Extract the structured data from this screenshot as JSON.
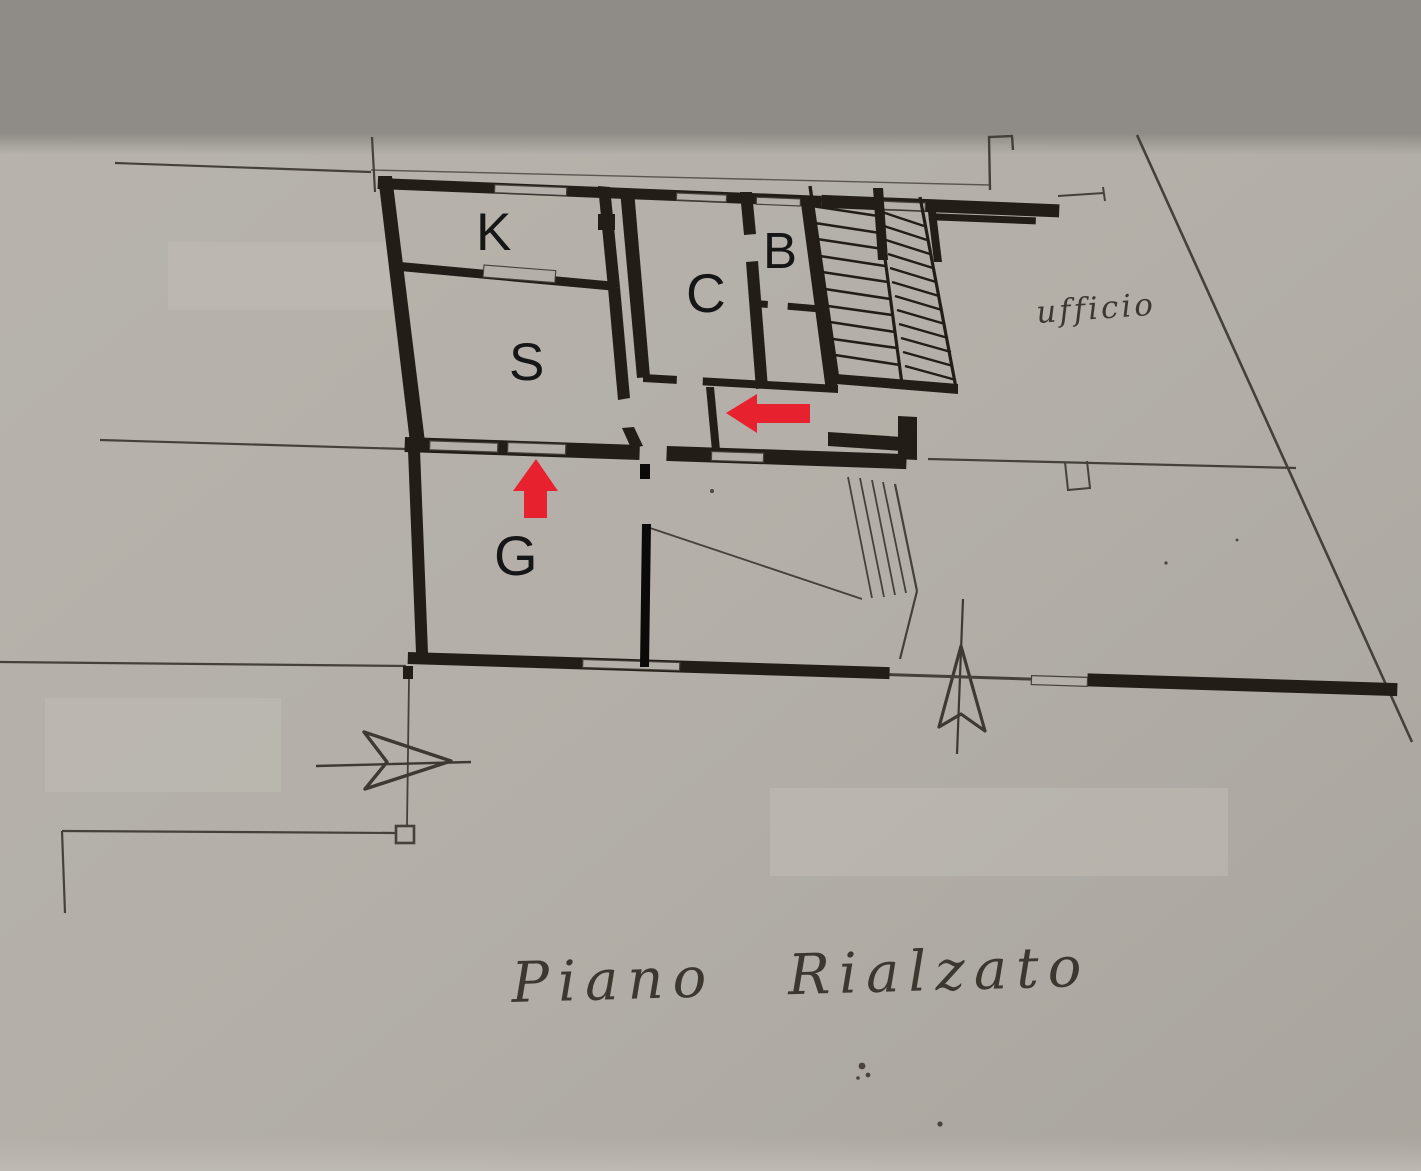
{
  "meta": {
    "drawing_type": "scanned architectural floor plan photo",
    "floor_title": "Piano Rialzato"
  },
  "rooms": [
    {
      "id": "room-k",
      "label": "K"
    },
    {
      "id": "room-s",
      "label": "S"
    },
    {
      "id": "room-c",
      "label": "C"
    },
    {
      "id": "room-b",
      "label": "B"
    },
    {
      "id": "room-g",
      "label": "G"
    }
  ],
  "handwritten": {
    "office_label": "ufficio",
    "floor_caption": "Piano Rialzato"
  },
  "markers": {
    "entrance_arrow": "red-up-arrow",
    "interior_arrow": "red-left-arrow",
    "arrow_color": "#e8212e"
  },
  "colors": {
    "paper": "#b4b0a9",
    "paper_dark": "#aaa69f",
    "ink_wall": "#221d17",
    "ink_thin": "#45403a",
    "shadow_band": "#8f8c87"
  }
}
